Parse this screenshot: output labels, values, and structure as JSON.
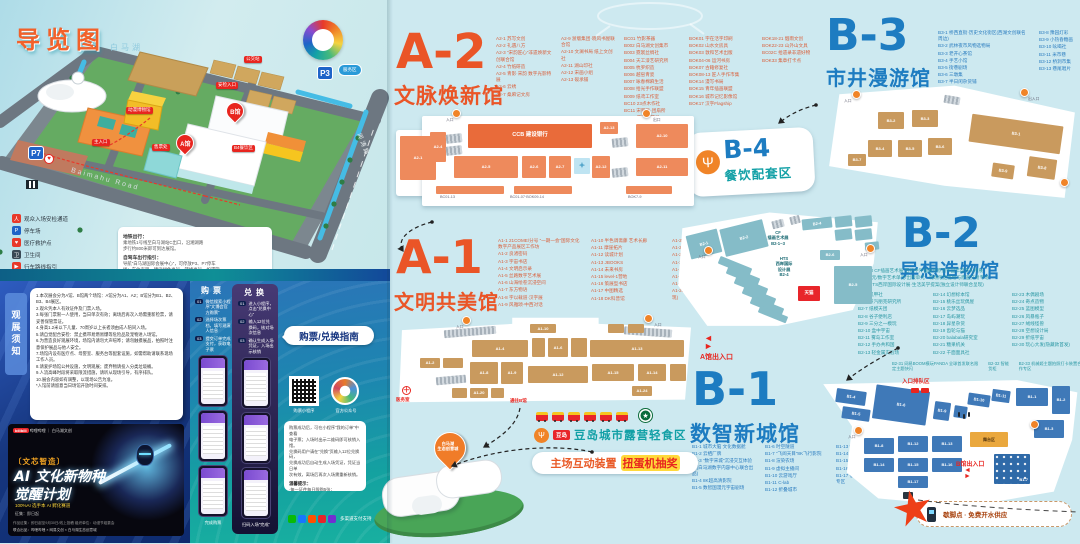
{
  "map_panel": {
    "title": "导览图",
    "lake": "白马湖",
    "road1": "Baimahu Road",
    "road2": "闻涛路",
    "p7": "P7",
    "p3": "P3",
    "service_badge": "服务区",
    "pin_a": "A馆",
    "pin_b": "B馆",
    "tags": [
      {
        "x": 244,
        "y": 56,
        "t": "公交站",
        "c": "tag"
      },
      {
        "x": 216,
        "y": 82,
        "t": "安检入口",
        "c": "tag"
      },
      {
        "x": 126,
        "y": 107,
        "t": "动漫博物馆",
        "c": "tag"
      },
      {
        "x": 92,
        "y": 139,
        "t": "主入口",
        "c": "tag"
      },
      {
        "x": 152,
        "y": 144,
        "t": "售票处",
        "c": "tag"
      },
      {
        "x": 232,
        "y": 145,
        "t": "B4餐饮区",
        "c": "tag"
      }
    ],
    "legend": [
      {
        "g": "人",
        "bg": "#e8392a",
        "label": "观众入场安检通道"
      },
      {
        "g": "P",
        "bg": "#1f64c8",
        "label": "停车场"
      },
      {
        "g": "♥",
        "bg": "#e8392a",
        "label": "医疗救护点"
      },
      {
        "g": "卫",
        "bg": "#3a4a55",
        "label": "卫生间"
      },
      {
        "g": "▶",
        "bg": "#e8392a",
        "label": "行车路线指引"
      }
    ],
    "tips": {
      "t1": "地铁出行：",
      "l1": [
        "乘地铁1号线至白马湖站C出口，沿湘湖路",
        "步行约800米即可到达展馆。"
      ],
      "t2": "自驾车出行指引：",
      "l2": [
        "导航“白马湖国际会展中心”，可停放P3、P7停车",
        "场；车位有限，建议绿色出行、错峰出行。如遇管",
        "制，请按现场交警及工作人员指引有序停放。"
      ]
    }
  },
  "notice": {
    "tab": "观展须知",
    "lines": [
      "1.本次展会分为A馆、B馆两个场馆：A馆分为A1、A2；B馆分为B1、B2、B3、B4展区。",
      "2.观众凭本人有效证件及门票入场。",
      "3.每张门票限一人使用，当日单次有效；离场后再次入场需重新检票，请妥善保管票证。",
      "4.身高1.2米以下儿童、70周岁以上长者须由成人陪同入场。",
      "5.请自觉配合安检：禁止携带易燃易爆等危险品及宠物进入场馆。",
      "6.为营造良好观展环境，场馆内请勿大声喧哗；请勿触摸展品，拍照时注意保护展品与他人安全。",
      "7.场馆内设有医疗点、母婴室、服务台等配套设施，如需帮助请联系现场工作人员。",
      "8.请爱护场馆公共设施，文明观展；废弃物请投入分类垃圾桶。",
      "9.人流高峰时段将采取限流措施，请听从现场引导，有序排队。",
      "10.展会内容如有调整，以现场公告为准。",
      "*入馆前请留意当日场馆开放时间安排。"
    ]
  },
  "poster": {
    "brands": "哔哩哔哩 ｜ 白马湖文创",
    "brand_badge": "bilibili",
    "series": "〔文芯智造〕",
    "t1": "AI 文化新物种",
    "t2": "觉醒计划",
    "sub": "100%AI 选手本 AI 孵化赛道",
    "line": "征集：即日起",
    "f1": "作品征集：即日起至9月30日/线上投稿    组织单位：动漫节组委会",
    "f2": "联合出品：哔哩哔哩 × 网易文创 × 白马湖生态创意城"
  },
  "guide": {
    "bubble": "购票/兑换指南",
    "buy_header": "购票",
    "redeem_header": "兑换",
    "buy_steps": [
      {
        "b": "01",
        "t": "微信搜索小程序“文博会官方购票”"
      },
      {
        "b": "02",
        "t": "选择场次票档，填写观演人信息"
      },
      {
        "b": "03",
        "t": "提交订单完成支付，获取电子票"
      }
    ],
    "buy_footer": "完成购票",
    "redeem_steps": [
      {
        "b": "01",
        "t": "进入小程序，点击“兑换中心”"
      },
      {
        "b": "02",
        "t": "输入12位兑换码，核对场次信息"
      },
      {
        "b": "03",
        "t": "确认生成入场凭证，入场出示核销"
      }
    ],
    "redeem_footer": "扫码入场“完成”",
    "qr_caption": "购票小程序",
    "badge_caption": "官方公众号",
    "box_lines": [
      "购票成功后，可在小程序“我的订单”中查看",
      "电子票；入场时出示二维码即可核销入馆。",
      "兑换码用户请在“兑换”页输入12位兑换码，",
      "兑换成功后自动生成入场凭证，凭证当日单",
      "次有效，离场后再次入场需重新核销。"
    ],
    "tip_title": "温馨提示：",
    "tip_lines": [
      "·每一证件每日限购5张；",
      "·电子票一经售出不退不换。"
    ],
    "pay_caption": "多渠道支付支持"
  },
  "halls": {
    "a2": {
      "code": "A-2",
      "name": "文脉焕新馆"
    },
    "a1": {
      "code": "A-1",
      "name": "文明共美馆"
    },
    "b1": {
      "code": "B-1",
      "name": "数智新城馆"
    },
    "b2": {
      "code": "B-2",
      "name": "异想造物馆"
    },
    "b3": {
      "code": "B-3",
      "name": "市井漫游馆"
    },
    "b4": {
      "code": "B-4",
      "name": "餐饮配套区",
      "icon": "Ψ"
    }
  },
  "a2_list": {
    "c1": [
      "A2-1 苏写文创",
      "A2-2 礼遇八方",
      "A2-3 “宋韵匠心”非遗焕新文创联合馆",
      "A2-4 竹纸研造",
      "A2-5 青影·宋韵 数字光影特展",
      "A2-6 云绣",
      "A2-7 桑麻记文房"
    ],
    "c2": [
      "A2-9 浙版集团·晓风书屋联合馆",
      "A2-10 文澜书局 纸上文创社",
      "A2-11 湖山印社",
      "A2-12 宋画小组",
      "A2-13 砚承铺"
    ],
    "c3": [
      "BC01 竹影茶器",
      "B002 白马湖文创集市",
      "B003 霓裳丝绸社",
      "B004 天工漆艺研究所",
      "B005 杭罗织造",
      "B006 越窑青瓷",
      "B007 咏春棉麻生活",
      "B008 拾光手作联盟",
      "B009 纸鸢工作室",
      "BC10 23点木作社",
      "BC11 宋服集·团扇所",
      "BC12 南宋点茶局"
    ],
    "c4": [
      "BOK01 字在活字印刷",
      "BOK02 山水文房具",
      "BOK03 敦和艺术出版",
      "BOK04-06 运河书房",
      "BOK07 古籍修复社",
      "BOK08-13 匠人手作市集",
      "BOK14 漫写书局",
      "BOK15 青年插画联盟",
      "BOK16 城市记忆影像馆",
      "BOK17 汉字Flagship"
    ],
    "c5": [
      "BOK18-21 烟雨文创",
      "BOK22-23 山外山文具",
      "BC02C 拾遗录非遗好物",
      "BOK33 集章打卡点"
    ]
  },
  "a1_list": {
    "c1": [
      "A1-1 21COME/分号 “一期一会”国际文化数字产品展区工作坊",
      "A1-2 良渚密码",
      "A1-3 宇宙书店",
      "A1-4 文明启示录",
      "A1-5 丝路数字艺术展",
      "A1-6 山海绘卷沉浸空间",
      "A1-7 东方物语",
      "A1-8 字以载道·汉字展",
      "A1-9 风雅颂·中西对话"
    ],
    "c2": [
      "A1-10 半色调斋藤 艺术长廊",
      "A1-11 摩崖拓片",
      "A1-12 读城计划",
      "A1-13 JBOOKS",
      "A1-14 未来书房",
      "A1-15 level-1营地",
      "A1-16 策展型书店",
      "A1-17 中图精选",
      "A1-18 DK科普馆"
    ],
    "c3": [
      "A1-20 欧洲插画原作特展",
      "A1-21 西文善本巡展",
      "A1-22 Musée在线+",
      "A1-23~26 百年社",
      "A1-25 国家地理经典影像、限定复刻",
      "A1-26 VSC首尔馆·限量艺术微喷",
      "A1-27 译文纪实线·世界文学地图计划",
      "A1-28 拉美理想国·环球特展(限定首展·特别呈现)"
    ]
  },
  "b3_list": {
    "c1": [
      "B3-1 桥西直街·历史文化街区(西湖文创联名周边)",
      "B3-2 武林夜市风物选物局",
      "B3-3 老开心茶馆",
      "B3-4 手艺小馆",
      "B3-5 街巷剧场",
      "B3-6 三墩集",
      "B3-7 半日闲杂货铺"
    ],
    "c2": [
      "B3-8 豫园灯彩",
      "B3-9 小热昏糖画",
      "B3-10 吆喝社",
      "B3-11 米市巷",
      "B3-12 桥洞市集",
      "B3-13 巷尾唱片"
    ]
  },
  "b2_list": {
    "header": [
      "B2-1~3 CF插画艺术展·百组中外插画师原创作品年度巡礼特展",
      "新锐单元/数字艺术单元/出版单元 · 现场限定签绘与原画交易专场",
      "B2-4 HTS西岸国际设计展·生活美学提案(独立设计师联合呈现)"
    ],
    "c1": [
      "B2-5 机甲社",
      "B2-6 蒸汽朋克研究所",
      "B2-7 纸模天团",
      "B2-8 谷子便利店",
      "B2-9 三分之一模玩",
      "B2-10 盒中宇宙",
      "B2-11 雾岛工作室",
      "B2-12 手办共和国",
      "B2-13 轻金属实验场"
    ],
    "c2": [
      "B2-14 幻想标本馆",
      "B2-15 桃乐丝玩偶屋",
      "B2-16 云梦选品",
      "B2-17 岛屿潮玩",
      "B2-18 异星杂货",
      "B2-19 齿轮与猫",
      "B2-20 balabala研究室",
      "B2-21 糖果机关",
      "B2-22 千面面具社"
    ],
    "c3": [
      "B2-23 木偶剧场",
      "B2-24 奇点造物",
      "B2-25 蓝图模型",
      "B2-26 风暴瓶子",
      "B2-27 绒线怪兽",
      "B2-28 空想设计局",
      "B2-29 折纸宇宙",
      "B2-30 玩心大发(隐藏款首发)"
    ],
    "bottom": [
      "B2-31 网易BOOM模玩PANDA 全球首发联名限定主题快闪",
      "B2-32 智能货柜",
      "B2-33 机械姬主题拍照打卡装置合作专区"
    ]
  },
  "b1_list": {
    "c1": [
      "B1-1 城市大脑 文化数据舱",
      "B1-2 云栖厂牌",
      "B1-3 “数字宋城”沉浸交互体验馆(白马湖数字内容中心联合出品)",
      "B1-4 8K超高清影院",
      "B1-5 数智国漫元宇宙剧场"
    ],
    "c2": [
      "B1-6 时空隧道",
      "B1-7 “飞阅天目”8K飞行影院",
      "B1-8 渲染农场",
      "B1-9 虚拟主播间",
      "B1-10 云游戏厅",
      "B1-11 C-lab",
      "B1-12 折叠城市"
    ],
    "c3": [
      "B1-13 慢直播站",
      "B1-14 数字藏品",
      "B1-15 AI作曲工坊",
      "B1-16 机器人咖啡师",
      "B1-17 低空经济飞行器展示合作专区"
    ]
  },
  "plans": {
    "a2": [
      {
        "x": 4,
        "y": 24,
        "w": 36,
        "h": 44,
        "t": "A2-1"
      },
      {
        "x": 34,
        "y": 20,
        "w": 16,
        "h": 30,
        "t": "A2-4"
      },
      {
        "x": 50,
        "y": 22,
        "w": 16,
        "h": 9,
        "c": "bg",
        "r": -6
      },
      {
        "x": 50,
        "y": 34,
        "w": 16,
        "h": 9,
        "c": "bg",
        "r": -6
      },
      {
        "x": 72,
        "y": 12,
        "w": 124,
        "h": 24,
        "t": "CCB 建设银行",
        "c": "bo2"
      },
      {
        "x": 204,
        "y": 10,
        "w": 18,
        "h": 12,
        "t": "A2-13"
      },
      {
        "x": 216,
        "y": 26,
        "w": 16,
        "h": 9,
        "c": "bg",
        "r": -6
      },
      {
        "x": 240,
        "y": 12,
        "w": 52,
        "h": 24,
        "t": "A2-10"
      },
      {
        "x": 240,
        "y": 46,
        "w": 52,
        "h": 18,
        "t": "A2-11"
      },
      {
        "x": 216,
        "y": 56,
        "w": 16,
        "h": 9,
        "c": "bg",
        "r": -6
      },
      {
        "x": 58,
        "y": 44,
        "w": 64,
        "h": 22,
        "t": "A2-5"
      },
      {
        "x": 126,
        "y": 44,
        "w": 24,
        "h": 22,
        "t": "A2-6"
      },
      {
        "x": 153,
        "y": 44,
        "w": 22,
        "h": 22,
        "t": "A2-7"
      },
      {
        "x": 178,
        "y": 46,
        "w": 16,
        "h": 16,
        "t": "✦",
        "c": "bi"
      },
      {
        "x": 196,
        "y": 44,
        "w": 18,
        "h": 22,
        "t": "A2-12"
      },
      {
        "x": 40,
        "y": 74,
        "w": 68,
        "h": 8
      },
      {
        "x": 118,
        "y": 74,
        "w": 58,
        "h": 8
      },
      {
        "x": 230,
        "y": 74,
        "w": 46,
        "h": 8
      },
      {
        "x": 44,
        "y": 84,
        "t": "BC01-13",
        "c": "lbl"
      },
      {
        "x": 114,
        "y": 84,
        "t": "BC01-07·BOK09-14",
        "c": "lbl"
      },
      {
        "x": 232,
        "y": 84,
        "t": "BOK7-9",
        "c": "lbl"
      },
      {
        "x": 56,
        "y": -3,
        "c": "gate"
      },
      {
        "x": 246,
        "y": -3,
        "c": "gate"
      },
      {
        "x": 50,
        "y": 7,
        "t": "入口",
        "c": "lbl"
      },
      {
        "x": 257,
        "y": 7,
        "t": "出口",
        "c": "lbl"
      }
    ],
    "a1": [
      {
        "x": 48,
        "y": 12,
        "w": 52,
        "h": 8,
        "c": "bg",
        "r": -5
      },
      {
        "x": 228,
        "y": 12,
        "w": 48,
        "h": 8,
        "c": "bg",
        "r": 4
      },
      {
        "x": 134,
        "y": 8,
        "w": 26,
        "h": 9,
        "t": "A1-10"
      },
      {
        "x": 212,
        "y": 8,
        "w": 16,
        "h": 9
      },
      {
        "x": 232,
        "y": 8,
        "w": 16,
        "h": 9
      },
      {
        "x": 76,
        "y": 24,
        "w": 56,
        "h": 17,
        "t": "A1-4"
      },
      {
        "x": 136,
        "y": 22,
        "w": 13,
        "h": 19
      },
      {
        "x": 152,
        "y": 22,
        "w": 20,
        "h": 19,
        "t": "A1-6"
      },
      {
        "x": 175,
        "y": 22,
        "w": 16,
        "h": 19
      },
      {
        "x": 194,
        "y": 24,
        "w": 94,
        "h": 17,
        "t": "A1-13"
      },
      {
        "x": 24,
        "y": 42,
        "w": 20,
        "h": 10,
        "t": "A1-2"
      },
      {
        "x": 47,
        "y": 42,
        "w": 20,
        "h": 10
      },
      {
        "x": 74,
        "y": 46,
        "w": 28,
        "h": 22,
        "t": "A1-8"
      },
      {
        "x": 105,
        "y": 46,
        "w": 22,
        "h": 22,
        "t": "A1-9"
      },
      {
        "x": 132,
        "y": 50,
        "w": 60,
        "h": 17,
        "t": "A1-12"
      },
      {
        "x": 196,
        "y": 48,
        "w": 42,
        "h": 17,
        "t": "A1-15"
      },
      {
        "x": 242,
        "y": 48,
        "w": 28,
        "h": 17,
        "t": "A1-14"
      },
      {
        "x": 274,
        "y": 48,
        "w": 16,
        "h": 17
      },
      {
        "x": 40,
        "y": 60,
        "w": 30,
        "h": 8,
        "c": "bg",
        "r": -5
      },
      {
        "x": 56,
        "y": 72,
        "w": 15,
        "h": 10
      },
      {
        "x": 74,
        "y": 72,
        "w": 18,
        "h": 10,
        "t": "A1-20"
      },
      {
        "x": 95,
        "y": 72,
        "w": 13,
        "h": 10
      },
      {
        "x": 236,
        "y": 70,
        "w": 20,
        "h": 10,
        "t": "A1-24"
      },
      {
        "x": 66,
        "y": 0,
        "c": "gate"
      },
      {
        "x": 248,
        "y": -2,
        "c": "gate"
      },
      {
        "x": 60,
        "y": 10,
        "t": "入口",
        "c": "lbl"
      },
      {
        "x": 258,
        "y": 8,
        "t": "入口",
        "c": "lbl"
      },
      {
        "x": 6,
        "y": 70,
        "t": "＋",
        "c": "med"
      },
      {
        "x": 0,
        "y": 82,
        "t": "医务室",
        "c": "redl"
      },
      {
        "x": 114,
        "y": 83,
        "t": "通往B馆",
        "c": "redl"
      }
    ],
    "b3": [
      {
        "x": 120,
        "y": 14,
        "w": 16,
        "h": 8,
        "c": "bg",
        "r": 10
      },
      {
        "x": 54,
        "y": 30,
        "w": 26,
        "h": 17,
        "t": "B3-2"
      },
      {
        "x": 88,
        "y": 28,
        "w": 26,
        "h": 17,
        "t": "B3-3"
      },
      {
        "x": 44,
        "y": 58,
        "w": 24,
        "h": 17,
        "t": "B3-4"
      },
      {
        "x": 74,
        "y": 58,
        "w": 24,
        "h": 17,
        "t": "B3-5"
      },
      {
        "x": 104,
        "y": 56,
        "w": 24,
        "h": 17,
        "t": "B3-6"
      },
      {
        "x": 146,
        "y": 38,
        "w": 92,
        "h": 28,
        "t": "B3-1",
        "r": 8
      },
      {
        "x": 204,
        "y": 76,
        "w": 28,
        "h": 20,
        "t": "B3-8",
        "r": 8
      },
      {
        "x": 168,
        "y": 82,
        "w": 22,
        "h": 14,
        "t": "B3-9",
        "r": 8
      },
      {
        "x": 24,
        "y": 72,
        "w": 18,
        "h": 12,
        "t": "B3-7"
      },
      {
        "x": 28,
        "y": 8,
        "c": "gate"
      },
      {
        "x": 196,
        "y": 6,
        "c": "gate"
      },
      {
        "x": 236,
        "y": 96,
        "c": "gate"
      },
      {
        "x": 20,
        "y": 18,
        "t": "入口",
        "c": "lbl"
      },
      {
        "x": 204,
        "y": 16,
        "t": "出入口",
        "c": "lbl"
      }
    ],
    "b2": [
      {
        "x": 14,
        "y": 22,
        "w": 32,
        "h": 24,
        "t": "B2-1",
        "r": -14
      },
      {
        "x": 48,
        "y": 14,
        "w": 44,
        "h": 28,
        "t": "B2-2",
        "r": -14
      },
      {
        "x": 98,
        "y": 10,
        "w": 12,
        "h": 8,
        "c": "bg",
        "r": -14
      },
      {
        "x": 116,
        "y": 6,
        "w": 10,
        "h": 8,
        "c": "bg",
        "r": -14
      },
      {
        "x": 128,
        "y": 8,
        "w": 30,
        "h": 11,
        "t": "B2-4",
        "r": -6
      },
      {
        "x": 161,
        "y": 6,
        "w": 17,
        "h": 11,
        "r": -6
      },
      {
        "x": 181,
        "y": 6,
        "w": 17,
        "h": 11,
        "r": -6
      },
      {
        "x": 161,
        "y": 19,
        "w": 17,
        "h": 11,
        "r": -6
      },
      {
        "x": 181,
        "y": 19,
        "w": 17,
        "h": 11,
        "r": -6
      },
      {
        "x": 191,
        "y": 32,
        "w": 14,
        "h": 8,
        "r": -6
      },
      {
        "x": 44,
        "y": 52,
        "w": 34,
        "h": 8,
        "r": 22
      },
      {
        "x": 52,
        "y": 62,
        "w": 34,
        "h": 8,
        "r": 22
      },
      {
        "x": 60,
        "y": 72,
        "w": 34,
        "h": 8,
        "r": 22
      },
      {
        "x": 68,
        "y": 82,
        "w": 34,
        "h": 8,
        "r": 22
      },
      {
        "x": 76,
        "y": 92,
        "w": 34,
        "h": 8,
        "r": 22
      },
      {
        "x": 84,
        "y": 101,
        "w": 30,
        "h": 7,
        "r": 22
      },
      {
        "x": 146,
        "y": 40,
        "w": 20,
        "h": 10,
        "t": "B2-6"
      },
      {
        "x": 160,
        "y": 56,
        "w": 38,
        "h": 38,
        "t": "B2-5"
      },
      {
        "x": 124,
        "y": 76,
        "w": 22,
        "h": 15,
        "t": "天猫",
        "c": "br"
      },
      {
        "x": 30,
        "y": 36,
        "c": "gate"
      },
      {
        "x": 192,
        "y": 34,
        "c": "gate"
      },
      {
        "x": 24,
        "y": 46,
        "t": "入口",
        "c": "lbl"
      },
      {
        "x": 186,
        "y": 44,
        "t": "入口",
        "c": "lbl"
      }
    ],
    "b1": [
      {
        "x": 18,
        "y": 14,
        "w": 30,
        "h": 14,
        "t": "B1-4",
        "r": 8
      },
      {
        "x": 24,
        "y": 32,
        "w": 28,
        "h": 12,
        "t": "B1-5",
        "r": 8
      },
      {
        "x": 56,
        "y": 12,
        "w": 54,
        "h": 34,
        "t": "B1-6",
        "r": 8
      },
      {
        "x": 116,
        "y": 26,
        "w": 16,
        "h": 18,
        "t": "B1-9",
        "r": 8
      },
      {
        "x": 136,
        "y": 30,
        "w": 13,
        "h": 12,
        "r": 8
      },
      {
        "x": 150,
        "y": 18,
        "w": 22,
        "h": 12,
        "t": "B1-10",
        "r": 8
      },
      {
        "x": 174,
        "y": 14,
        "w": 18,
        "h": 12,
        "t": "B1-11",
        "r": 8
      },
      {
        "x": 198,
        "y": 12,
        "w": 32,
        "h": 18,
        "t": "B1-1"
      },
      {
        "x": 234,
        "y": 10,
        "w": 18,
        "h": 28,
        "t": "B1-2"
      },
      {
        "x": 216,
        "y": 44,
        "w": 30,
        "h": 18,
        "t": "B1-3"
      },
      {
        "x": 46,
        "y": 62,
        "w": 30,
        "h": 16,
        "t": "B1-8"
      },
      {
        "x": 80,
        "y": 60,
        "w": 30,
        "h": 16,
        "t": "B1-12"
      },
      {
        "x": 114,
        "y": 60,
        "w": 30,
        "h": 16,
        "t": "B1-13"
      },
      {
        "x": 46,
        "y": 82,
        "w": 30,
        "h": 14,
        "t": "B1-14"
      },
      {
        "x": 80,
        "y": 82,
        "w": 30,
        "h": 14,
        "t": "B1-15"
      },
      {
        "x": 114,
        "y": 82,
        "w": 30,
        "h": 14,
        "t": "B1-16"
      },
      {
        "x": 80,
        "y": 100,
        "w": 30,
        "h": 12,
        "t": "B1-17"
      },
      {
        "x": 152,
        "y": 56,
        "w": 38,
        "h": 15,
        "t": "舞台区",
        "c": "by"
      },
      {
        "x": 176,
        "y": 78,
        "w": 36,
        "h": 30,
        "t": "B1-7",
        "c": "bs"
      },
      {
        "x": 93,
        "y": 12,
        "c": "car"
      },
      {
        "x": 103,
        "y": 12,
        "c": "car"
      },
      {
        "x": 140,
        "y": 36,
        "c": "fig"
      },
      {
        "x": 145,
        "y": 38,
        "c": "fig"
      },
      {
        "x": 150,
        "y": 36,
        "c": "fig"
      },
      {
        "x": 36,
        "y": 50,
        "c": "gate"
      },
      {
        "x": 212,
        "y": 44,
        "c": "gate"
      },
      {
        "x": 30,
        "y": 60,
        "t": "入口",
        "c": "lbl"
      }
    ]
  },
  "plan_texts": {
    "cf": "CF\n插画艺术展\nB2-1~3",
    "hts": "HTS\n西岸国际\n设计展\nB2-4",
    "a1_exit": "A馆出入口",
    "a1_to_b": "通往B馆",
    "b1_queue": "入口排队区",
    "b1_exit": "B馆出入口"
  },
  "food": {
    "logo": "豆岛",
    "title": "豆岛城市露营轻食区",
    "pill1": "主场互动装置",
    "pill2": "扭蛋机抽奖"
  },
  "misc": {
    "water_note": "歇脚点 · 免费开水供应",
    "building_pin": "白马湖\n生态创意城"
  }
}
